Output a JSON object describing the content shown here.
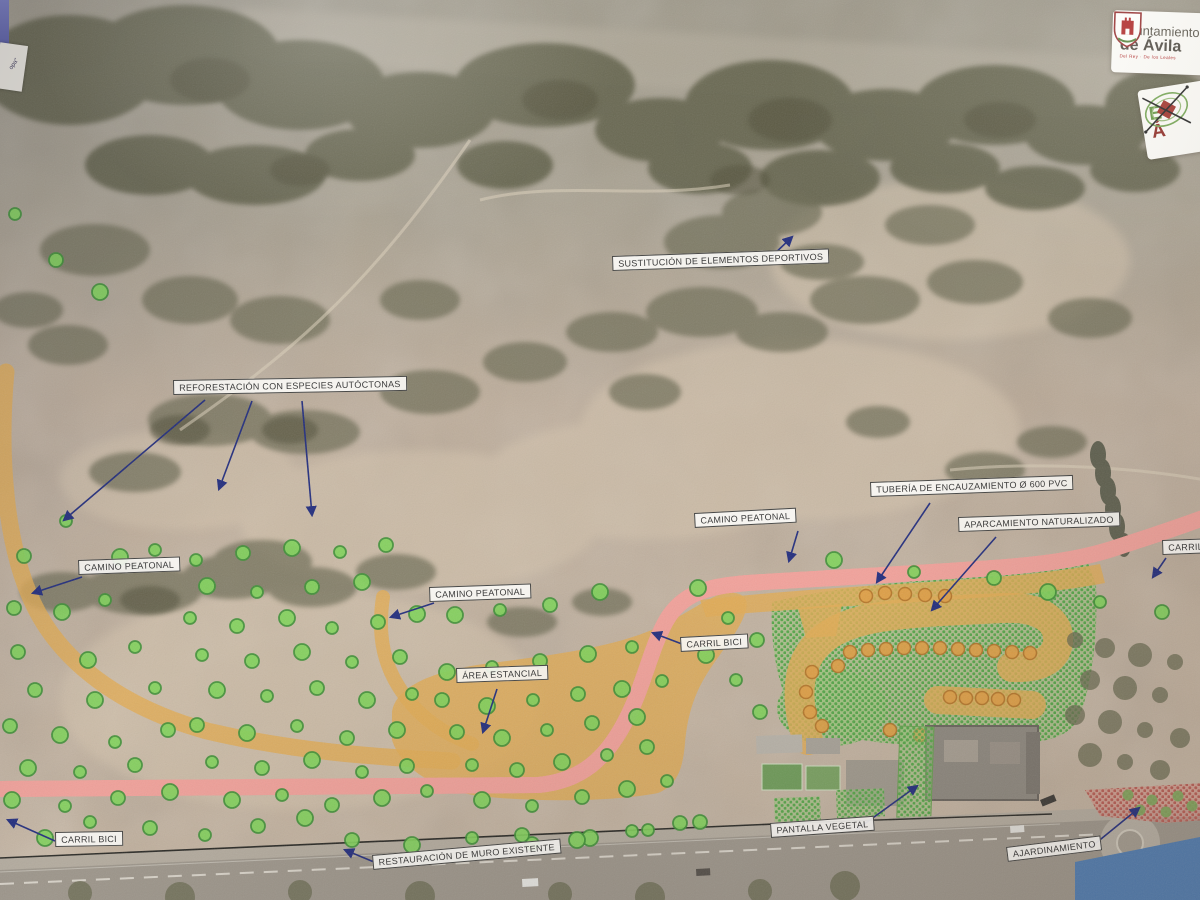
{
  "photo": {
    "corner_fragment_text": "opa\"",
    "logos": {
      "ayuntamiento": {
        "line1": "Ayuntamiento",
        "line2": "de Ávila",
        "motto": "Del Rey · De los Leales"
      },
      "badge": {
        "letter_top": "E",
        "letter_bottom": "Á"
      }
    }
  },
  "map": {
    "colors": {
      "pedestrian_path": "#e2ac55",
      "bike_lane": "#f2a29b",
      "planned_tree": "#82d45c",
      "planned_tree_ring": "#3f9237",
      "parking_tree": "#e0a047",
      "parking_tree_ring": "#b5762a",
      "existing_tree": "#6a6b52",
      "garden_tree": "#7ca75b",
      "annotation_arrow": "#232e7e"
    },
    "labels": [
      {
        "id": "sustitucion-deportivos",
        "text": "SUSTITUCIÓN DE ELEMENTOS DEPORTIVOS",
        "x": 612,
        "y": 256,
        "rot": -2,
        "arrows": [
          [
            770,
            258,
            792,
            237
          ]
        ]
      },
      {
        "id": "reforestacion",
        "text": "REFORESTACIÓN CON ESPECIES AUTÓCTONAS",
        "x": 173,
        "y": 380,
        "rot": -1,
        "arrows": [
          [
            205,
            400,
            64,
            520
          ],
          [
            252,
            401,
            219,
            489
          ],
          [
            302,
            401,
            312,
            515
          ]
        ]
      },
      {
        "id": "tuberia-encauzamiento",
        "text": "TUBERÍA DE ENCAUZAMIENTO Ø 600 PVC",
        "x": 870,
        "y": 482,
        "rot": -2,
        "arrows": [
          [
            930,
            503,
            877,
            582
          ]
        ]
      },
      {
        "id": "camino-peatonal-1",
        "text": "CAMINO PEATONAL",
        "x": 694,
        "y": 513,
        "rot": -3,
        "arrows": [
          [
            798,
            531,
            789,
            561
          ]
        ]
      },
      {
        "id": "aparcamiento-naturalizado",
        "text": "APARCAMIENTO NATURALIZADO",
        "x": 958,
        "y": 517,
        "rot": -2,
        "arrows": [
          [
            996,
            537,
            932,
            610
          ]
        ]
      },
      {
        "id": "carril-bici-derecha",
        "text": "CARRIL BICI",
        "x": 1162,
        "y": 540,
        "rot": -2,
        "arrows": [
          [
            1166,
            558,
            1153,
            577
          ]
        ]
      },
      {
        "id": "camino-peatonal-2",
        "text": "CAMINO PEATONAL",
        "x": 78,
        "y": 560,
        "rot": -2,
        "arrows": [
          [
            82,
            577,
            33,
            593
          ]
        ]
      },
      {
        "id": "camino-peatonal-3",
        "text": "CAMINO PEATONAL",
        "x": 429,
        "y": 587,
        "rot": -2,
        "arrows": [
          [
            434,
            603,
            391,
            617
          ]
        ]
      },
      {
        "id": "carril-bici-medio",
        "text": "CARRIL BICI",
        "x": 680,
        "y": 637,
        "rot": -3,
        "arrows": [
          [
            682,
            644,
            653,
            633
          ]
        ]
      },
      {
        "id": "area-estancial",
        "text": "ÁREA ESTANCIAL",
        "x": 456,
        "y": 668,
        "rot": -2,
        "arrows": [
          [
            497,
            689,
            483,
            732
          ]
        ]
      },
      {
        "id": "carril-bici-izquierda",
        "text": "CARRIL BICI",
        "x": 55,
        "y": 832,
        "rot": -1,
        "arrows": [
          [
            55,
            841,
            8,
            820
          ]
        ]
      },
      {
        "id": "pantalla-vegetal",
        "text": "PANTALLA VEGETAL",
        "x": 770,
        "y": 823,
        "rot": -4,
        "arrows": [
          [
            856,
            830,
            917,
            786
          ]
        ]
      },
      {
        "id": "restauracion-muro",
        "text": "RESTAURACIÓN DE MURO EXISTENTE",
        "x": 372,
        "y": 855,
        "rot": -5,
        "arrows": [
          [
            374,
            862,
            345,
            850
          ]
        ]
      },
      {
        "id": "ajardinamiento",
        "text": "AJARDINAMIENTO",
        "x": 1006,
        "y": 847,
        "rot": -7,
        "arrows": [
          [
            1085,
            852,
            1139,
            808
          ]
        ]
      }
    ],
    "green_trees": [
      [
        15,
        214
      ],
      [
        56,
        260
      ],
      [
        100,
        292
      ],
      [
        66,
        521
      ],
      [
        24,
        556
      ],
      [
        120,
        557
      ],
      [
        155,
        550
      ],
      [
        14,
        608
      ],
      [
        62,
        612
      ],
      [
        105,
        600
      ],
      [
        18,
        652
      ],
      [
        88,
        660
      ],
      [
        135,
        647
      ],
      [
        35,
        690
      ],
      [
        95,
        700
      ],
      [
        155,
        688
      ],
      [
        10,
        726
      ],
      [
        60,
        735
      ],
      [
        115,
        742
      ],
      [
        168,
        730
      ],
      [
        28,
        768
      ],
      [
        80,
        772
      ],
      [
        135,
        765
      ],
      [
        12,
        800
      ],
      [
        65,
        806
      ],
      [
        118,
        798
      ],
      [
        170,
        792
      ],
      [
        90,
        822
      ],
      [
        150,
        828
      ],
      [
        45,
        838
      ],
      [
        205,
        835
      ],
      [
        258,
        826
      ],
      [
        305,
        818
      ],
      [
        196,
        560
      ],
      [
        243,
        553
      ],
      [
        292,
        548
      ],
      [
        340,
        552
      ],
      [
        386,
        545
      ],
      [
        207,
        586
      ],
      [
        257,
        592
      ],
      [
        312,
        587
      ],
      [
        362,
        582
      ],
      [
        190,
        618
      ],
      [
        237,
        626
      ],
      [
        287,
        618
      ],
      [
        332,
        628
      ],
      [
        378,
        622
      ],
      [
        417,
        614
      ],
      [
        202,
        655
      ],
      [
        252,
        661
      ],
      [
        302,
        652
      ],
      [
        352,
        662
      ],
      [
        400,
        657
      ],
      [
        217,
        690
      ],
      [
        267,
        696
      ],
      [
        317,
        688
      ],
      [
        367,
        700
      ],
      [
        412,
        694
      ],
      [
        197,
        725
      ],
      [
        247,
        733
      ],
      [
        297,
        726
      ],
      [
        347,
        738
      ],
      [
        397,
        730
      ],
      [
        212,
        762
      ],
      [
        262,
        768
      ],
      [
        312,
        760
      ],
      [
        362,
        772
      ],
      [
        407,
        766
      ],
      [
        232,
        800
      ],
      [
        282,
        795
      ],
      [
        332,
        805
      ],
      [
        382,
        798
      ],
      [
        427,
        791
      ],
      [
        352,
        840
      ],
      [
        412,
        845
      ],
      [
        472,
        838
      ],
      [
        532,
        844
      ],
      [
        590,
        838
      ],
      [
        648,
        830
      ],
      [
        700,
        822
      ],
      [
        447,
        672
      ],
      [
        492,
        667
      ],
      [
        540,
        661
      ],
      [
        588,
        654
      ],
      [
        632,
        647
      ],
      [
        442,
        700
      ],
      [
        487,
        706
      ],
      [
        533,
        700
      ],
      [
        578,
        694
      ],
      [
        622,
        689
      ],
      [
        662,
        681
      ],
      [
        457,
        732
      ],
      [
        502,
        738
      ],
      [
        547,
        730
      ],
      [
        592,
        723
      ],
      [
        637,
        717
      ],
      [
        472,
        765
      ],
      [
        517,
        770
      ],
      [
        562,
        762
      ],
      [
        607,
        755
      ],
      [
        647,
        747
      ],
      [
        482,
        800
      ],
      [
        532,
        806
      ],
      [
        582,
        797
      ],
      [
        627,
        789
      ],
      [
        667,
        781
      ],
      [
        522,
        835
      ],
      [
        577,
        840
      ],
      [
        632,
        831
      ],
      [
        680,
        823
      ],
      [
        698,
        588
      ],
      [
        728,
        618
      ],
      [
        757,
        640
      ],
      [
        706,
        655
      ],
      [
        736,
        680
      ],
      [
        760,
        712
      ],
      [
        834,
        560
      ],
      [
        914,
        572
      ],
      [
        994,
        578
      ],
      [
        1048,
        592
      ],
      [
        1100,
        602
      ],
      [
        1162,
        612
      ],
      [
        455,
        615
      ],
      [
        500,
        610
      ],
      [
        550,
        605
      ],
      [
        600,
        592
      ]
    ],
    "orange_trees": [
      [
        850,
        652
      ],
      [
        868,
        650
      ],
      [
        886,
        649
      ],
      [
        904,
        648
      ],
      [
        922,
        648
      ],
      [
        940,
        648
      ],
      [
        958,
        649
      ],
      [
        976,
        650
      ],
      [
        994,
        651
      ],
      [
        1012,
        652
      ],
      [
        1030,
        653
      ],
      [
        950,
        697
      ],
      [
        966,
        698
      ],
      [
        982,
        698
      ],
      [
        998,
        699
      ],
      [
        1014,
        700
      ],
      [
        812,
        672
      ],
      [
        806,
        692
      ],
      [
        810,
        712
      ],
      [
        822,
        726
      ],
      [
        838,
        666
      ],
      [
        866,
        596
      ],
      [
        885,
        593
      ],
      [
        905,
        594
      ],
      [
        925,
        595
      ],
      [
        945,
        596
      ],
      [
        890,
        730
      ],
      [
        920,
        735
      ]
    ],
    "olive_trees": [
      [
        1075,
        640
      ],
      [
        1105,
        648
      ],
      [
        1140,
        655
      ],
      [
        1175,
        662
      ],
      [
        1090,
        680
      ],
      [
        1125,
        688
      ],
      [
        1160,
        695
      ],
      [
        1075,
        715
      ],
      [
        1110,
        722
      ],
      [
        1145,
        730
      ],
      [
        1180,
        738
      ],
      [
        1090,
        755
      ],
      [
        1125,
        762
      ],
      [
        1160,
        770
      ],
      [
        80,
        893
      ],
      [
        180,
        897
      ],
      [
        300,
        892
      ],
      [
        420,
        896
      ],
      [
        560,
        894
      ],
      [
        650,
        897
      ],
      [
        760,
        891
      ],
      [
        845,
        886
      ]
    ],
    "garden_trees": [
      [
        1128,
        795
      ],
      [
        1152,
        800
      ],
      [
        1178,
        796
      ],
      [
        1140,
        810
      ],
      [
        1166,
        812
      ],
      [
        1192,
        806
      ]
    ]
  }
}
